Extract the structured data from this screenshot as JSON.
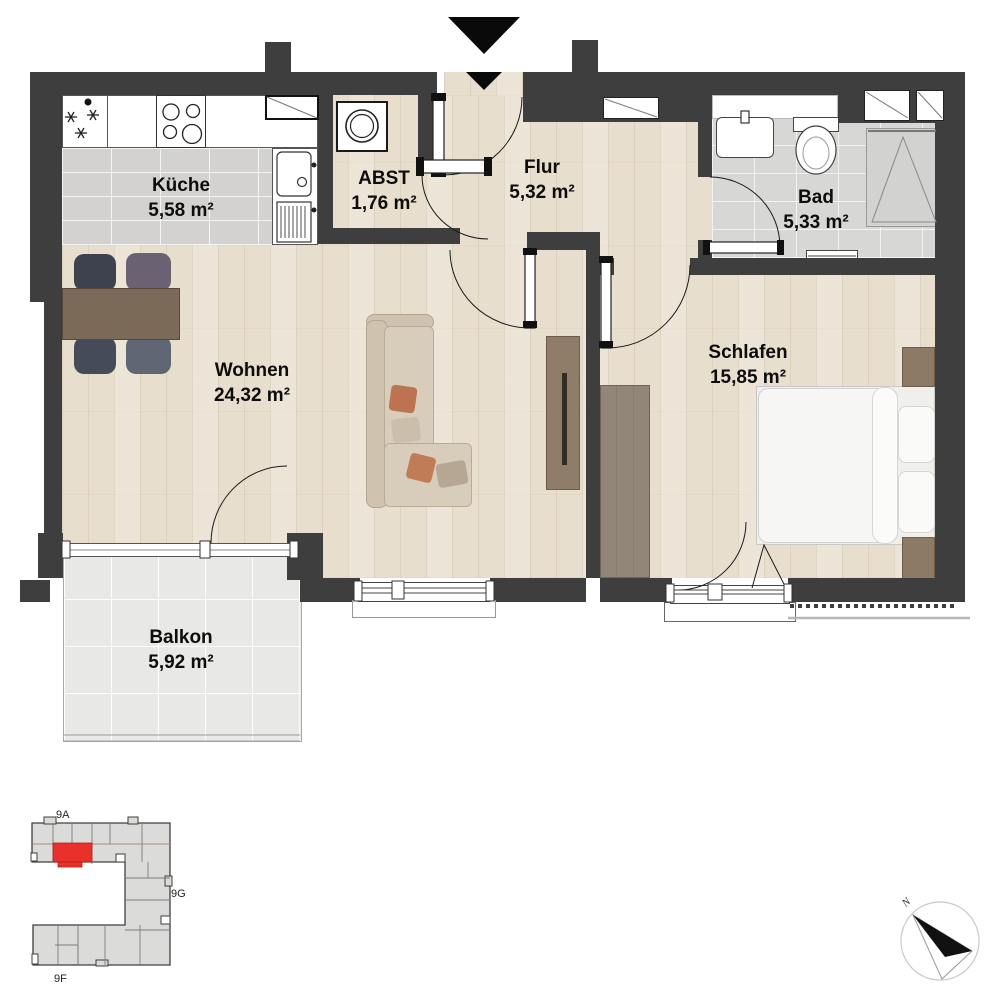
{
  "plan": {
    "rooms": [
      {
        "name": "Küche",
        "area": "5,58 m²"
      },
      {
        "name": "ABST",
        "area": "1,76 m²"
      },
      {
        "name": "Flur",
        "area": "5,32 m²"
      },
      {
        "name": "Bad",
        "area": "5,33 m²"
      },
      {
        "name": "Wohnen",
        "area": "24,32 m²"
      },
      {
        "name": "Schlafen",
        "area": "15,85 m²"
      },
      {
        "name": "Balkon",
        "area": "5,92 m²"
      }
    ]
  },
  "minimap": {
    "building_labels": [
      "9A",
      "9G",
      "9F"
    ],
    "highlight_color": "#e8312a"
  },
  "compass": {
    "north_label": "N"
  },
  "colors": {
    "wall": "#3f3e3e",
    "wood_floor": "#e8decd",
    "kitchen_tile": "#d3d2d0",
    "bath_tile": "#d7d7d5",
    "balcony_tile": "#e8e8e6",
    "unit_highlight": "#e8312a"
  }
}
